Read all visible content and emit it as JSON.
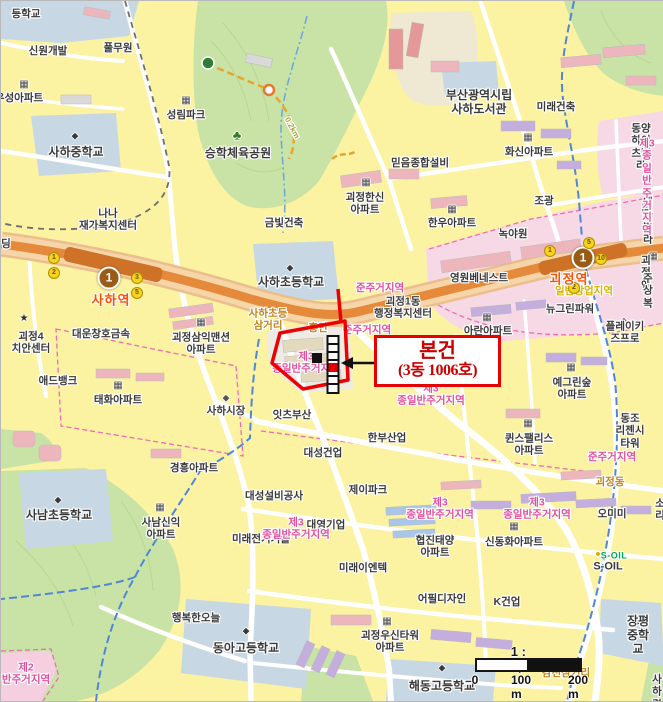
{
  "map": {
    "callout": {
      "line1": "본건",
      "line2": "(3동 1006호)"
    },
    "scale": {
      "ratio": "1 : 6,583",
      "t0": "0",
      "t100": "100 m",
      "t200": "200 m"
    },
    "subway_line": {
      "number": "1",
      "badge_color": "#9A5B17",
      "line_color": "#E58A3A"
    },
    "stations": [
      {
        "name": "사하역",
        "badge": "1",
        "bx": 108,
        "by": 277,
        "lx": 110,
        "ly": 299,
        "exits": [
          {
            "n": "1",
            "x": 53,
            "y": 257
          },
          {
            "n": "2",
            "x": 53,
            "y": 272
          },
          {
            "n": "3",
            "x": 136,
            "y": 277
          },
          {
            "n": "5",
            "x": 136,
            "y": 292
          }
        ]
      },
      {
        "name": "괴정역",
        "badge": "1",
        "bx": 582,
        "by": 257,
        "lx": 568,
        "ly": 278,
        "exits": [
          {
            "n": "1",
            "x": 549,
            "y": 250
          },
          {
            "n": "5",
            "x": 588,
            "y": 242
          },
          {
            "n": "10",
            "x": 600,
            "y": 258
          },
          {
            "n": "2",
            "x": 573,
            "y": 287
          }
        ]
      }
    ],
    "labels": [
      {
        "t": "등학교",
        "x": 25,
        "y": 13,
        "n": "label-school-partial"
      },
      {
        "t": "신원개발",
        "x": 47,
        "y": 50
      },
      {
        "t": "풀무원",
        "x": 117,
        "y": 47
      },
      {
        "t": "우성아파트",
        "x": 18,
        "y": 97
      },
      {
        "t": "사하중학교",
        "x": 75,
        "y": 151,
        "fs": 12,
        "n": "label-saha-middle-school"
      },
      {
        "t": "성림파크",
        "x": 185,
        "y": 114
      },
      {
        "t": "승학체육공원",
        "x": 237,
        "y": 152,
        "fs": 12,
        "n": "label-seunghak-sports-park"
      },
      {
        "t": "금빛건축",
        "x": 283,
        "y": 222
      },
      {
        "t": "나나\n재가복지센터",
        "x": 107,
        "y": 219
      },
      {
        "t": "딩",
        "x": 5,
        "y": 243
      },
      {
        "t": "부산광역시립\n사하도서관",
        "x": 478,
        "y": 101,
        "fs": 12,
        "n": "label-saha-library"
      },
      {
        "t": "미래건축",
        "x": 555,
        "y": 106
      },
      {
        "t": "화신아파트",
        "x": 528,
        "y": 151
      },
      {
        "t": "동양하이츠빌라",
        "x": 640,
        "y": 146
      },
      {
        "t": "믿음종합설비",
        "x": 419,
        "y": 162
      },
      {
        "t": "괴정한신\n아파트",
        "x": 364,
        "y": 203
      },
      {
        "t": "한우아파트",
        "x": 451,
        "y": 222
      },
      {
        "t": "조광",
        "x": 543,
        "y": 200
      },
      {
        "t": "녹야원",
        "x": 512,
        "y": 233
      },
      {
        "t": "대근빌라",
        "x": 647,
        "y": 220
      },
      {
        "t": "사하초등학교",
        "x": 290,
        "y": 281,
        "fs": 12,
        "n": "label-saha-elementary"
      },
      {
        "t": "괴정1동\n행정복지센터",
        "x": 402,
        "y": 307,
        "n": "label-goejeong1dong-office"
      },
      {
        "t": "영원베네스트",
        "x": 478,
        "y": 277
      },
      {
        "t": "뉴그린파워",
        "x": 569,
        "y": 308
      },
      {
        "t": "아란아파트",
        "x": 487,
        "y": 330
      },
      {
        "t": "괴정엔",
        "x": 645,
        "y": 272
      },
      {
        "t": "주상복",
        "x": 647,
        "y": 290
      },
      {
        "t": "플레이키즈프로",
        "x": 624,
        "y": 332
      },
      {
        "t": "대운창호금속",
        "x": 100,
        "y": 333
      },
      {
        "t": "괴정4\n치안센터",
        "x": 30,
        "y": 342
      },
      {
        "t": "괴정삼익맨션\n아파트",
        "x": 200,
        "y": 343
      },
      {
        "t": "애드뱅크",
        "x": 57,
        "y": 380
      },
      {
        "t": "태화아파트",
        "x": 117,
        "y": 399
      },
      {
        "t": "사하시장",
        "x": 225,
        "y": 410
      },
      {
        "t": "잇츠부산",
        "x": 291,
        "y": 414
      },
      {
        "t": "예그린숲\n아파트",
        "x": 571,
        "y": 388
      },
      {
        "t": "동조\n리젠시타워",
        "x": 629,
        "y": 430
      },
      {
        "t": "퀸스팰리스\n아파트",
        "x": 528,
        "y": 444
      },
      {
        "t": "한부산업",
        "x": 386,
        "y": 437
      },
      {
        "t": "대성건업",
        "x": 322,
        "y": 452
      },
      {
        "t": "경흥아파트",
        "x": 193,
        "y": 467
      },
      {
        "t": "제이파크",
        "x": 367,
        "y": 489
      },
      {
        "t": "대성설비공사",
        "x": 273,
        "y": 495
      },
      {
        "t": "사남초등학교",
        "x": 58,
        "y": 514,
        "fs": 12,
        "n": "label-sanam-elementary"
      },
      {
        "t": "사남신익\n아파트",
        "x": 160,
        "y": 528
      },
      {
        "t": "미래전기기술",
        "x": 260,
        "y": 538
      },
      {
        "t": "대영기업",
        "x": 325,
        "y": 524
      },
      {
        "t": "협진태양\n아파트",
        "x": 434,
        "y": 546
      },
      {
        "t": "신동화아파트",
        "x": 513,
        "y": 541
      },
      {
        "t": "오미미",
        "x": 611,
        "y": 513
      },
      {
        "t": "소리",
        "x": 659,
        "y": 509
      },
      {
        "t": "S-OIL",
        "x": 613,
        "y": 555,
        "cls": "soil-green",
        "fs": 9,
        "n": "label-soil-logo"
      },
      {
        "t": "S-OIL",
        "x": 607,
        "y": 566,
        "fs": 11,
        "n": "label-soil"
      },
      {
        "t": "미래이엔텍",
        "x": 362,
        "y": 567
      },
      {
        "t": "행복한오늘",
        "x": 195,
        "y": 617
      },
      {
        "t": "어필디자인",
        "x": 441,
        "y": 598
      },
      {
        "t": "K건업",
        "x": 506,
        "y": 601
      },
      {
        "t": "괴정우신타워\n아파트",
        "x": 389,
        "y": 641
      },
      {
        "t": "동아고등학교",
        "x": 245,
        "y": 647,
        "fs": 12,
        "n": "label-donga-high-school"
      },
      {
        "t": "장평중학교",
        "x": 637,
        "y": 634,
        "fs": 12,
        "n": "label-jangpyeong-middle-school"
      },
      {
        "t": "해동고등학교",
        "x": 441,
        "y": 685,
        "fs": 12,
        "n": "label-haedong-high-school"
      },
      {
        "t": "사하경",
        "x": 656,
        "y": 691
      },
      {
        "t": "사하초등\n삼거리",
        "x": 267,
        "y": 319,
        "cls": "roadname",
        "n": "label-saha-elem-junction"
      },
      {
        "t": "괴정동",
        "x": 609,
        "y": 481,
        "cls": "roadname",
        "n": "label-goejeongdong"
      },
      {
        "t": "감천삼거리",
        "x": 565,
        "y": 672,
        "cls": "roadname",
        "n": "label-gamcheon-junction"
      },
      {
        "t": "흥인",
        "x": 317,
        "y": 327,
        "cls": "roadname"
      },
      {
        "t": "준주거지역",
        "x": 379,
        "y": 287,
        "cls": "zone",
        "n": "label-zoning-semi-residential"
      },
      {
        "t": "준주거지역",
        "x": 366,
        "y": 329,
        "cls": "zone",
        "n": "label-zoning-semi-residential"
      },
      {
        "t": "제3\n종일반주거지역",
        "x": 305,
        "y": 362,
        "cls": "zone",
        "n": "label-zoning-class3-residential"
      },
      {
        "t": "제3\n종일반주거지역",
        "x": 430,
        "y": 394,
        "cls": "zone",
        "n": "label-zoning-class3-residential"
      },
      {
        "t": "준주거지역",
        "x": 611,
        "y": 456,
        "cls": "zone",
        "n": "label-zoning-semi-residential"
      },
      {
        "t": "제3\n종일반주거지역",
        "x": 439,
        "y": 508,
        "cls": "zone",
        "n": "label-zoning-class3-residential"
      },
      {
        "t": "제3\n종일반주거지역",
        "x": 536,
        "y": 508,
        "cls": "zone",
        "n": "label-zoning-class3-residential"
      },
      {
        "t": "제3\n종일반주거지역",
        "x": 295,
        "y": 528,
        "cls": "zone",
        "n": "label-zoning-class3-residential"
      },
      {
        "t": "제3\n종일반주거지역",
        "x": 646,
        "y": 186,
        "cls": "zone",
        "n": "label-zoning-class3-residential"
      },
      {
        "t": "제2\n반주거지역",
        "x": 25,
        "y": 673,
        "cls": "zone",
        "n": "label-zoning-class2-residential"
      },
      {
        "t": "일반상업지역",
        "x": 583,
        "y": 290,
        "cls": "zone-yellow",
        "n": "label-zoning-commercial"
      },
      {
        "t": "0.2km",
        "x": 291,
        "y": 127,
        "cls": "trail",
        "rot": 62,
        "fs": 8,
        "n": "label-trail-distance"
      }
    ],
    "icons": [
      {
        "n": "building-icon",
        "x": 23,
        "y": 84
      },
      {
        "n": "school-icon",
        "x": 74,
        "y": 135
      },
      {
        "n": "building-icon",
        "x": 185,
        "y": 100
      },
      {
        "n": "tree-icon",
        "x": 236,
        "y": 134
      },
      {
        "n": "school-icon",
        "x": 289,
        "y": 267
      },
      {
        "n": "building-icon",
        "x": 527,
        "y": 137
      },
      {
        "n": "building-icon",
        "x": 365,
        "y": 182
      },
      {
        "n": "building-icon",
        "x": 451,
        "y": 209
      },
      {
        "n": "building-icon",
        "x": 645,
        "y": 207
      },
      {
        "n": "building-icon",
        "x": 200,
        "y": 322
      },
      {
        "n": "police-icon",
        "x": 23,
        "y": 318
      },
      {
        "n": "building-icon",
        "x": 117,
        "y": 385
      },
      {
        "n": "market-icon",
        "x": 225,
        "y": 397
      },
      {
        "n": "building-icon",
        "x": 486,
        "y": 317
      },
      {
        "n": "bag-icon",
        "x": 623,
        "y": 320
      },
      {
        "n": "building-icon",
        "x": 570,
        "y": 367
      },
      {
        "n": "building-icon",
        "x": 527,
        "y": 423
      },
      {
        "n": "building-icon",
        "x": 513,
        "y": 526
      },
      {
        "n": "school-icon",
        "x": 57,
        "y": 499
      },
      {
        "n": "building-icon",
        "x": 159,
        "y": 507
      },
      {
        "n": "fuel-icon",
        "x": 597,
        "y": 553
      },
      {
        "n": "building-icon",
        "x": 386,
        "y": 621
      },
      {
        "n": "school-icon",
        "x": 245,
        "y": 630
      },
      {
        "n": "school-icon",
        "x": 637,
        "y": 620
      },
      {
        "n": "school-icon",
        "x": 441,
        "y": 667
      },
      {
        "n": "building-icon",
        "x": 652,
        "y": 256
      }
    ]
  }
}
